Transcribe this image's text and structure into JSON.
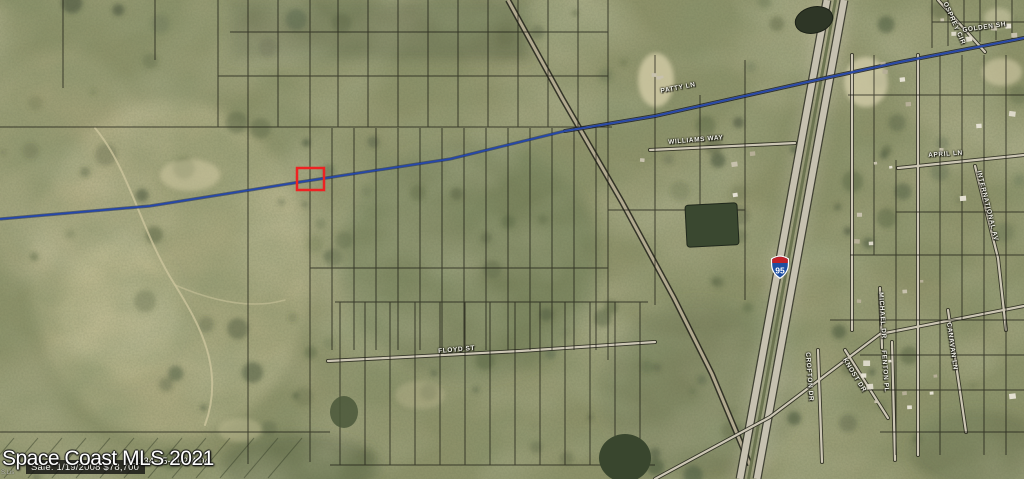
{
  "overlay": {
    "title": "Space Coast MLS 2021",
    "parcel_id": "21-34-15-AI-2-4.04",
    "sale_info": "Sale: 1/19/2008 $78,700",
    "corner_note": "S.Lis"
  },
  "map": {
    "type": "aerial-parcel-map",
    "highlighted_parcel_color": "#ee2222",
    "route_line_color": "#2547ab",
    "interstate_shield": {
      "number": "95"
    },
    "street_labels": [
      {
        "text": "PATTY LN",
        "x": 660,
        "y": 88,
        "rot": -11
      },
      {
        "text": "WILLIAMS WAY",
        "x": 668,
        "y": 139,
        "rot": -5
      },
      {
        "text": "FLOYD ST",
        "x": 438,
        "y": 348,
        "rot": -5
      },
      {
        "text": "GOLDEN SH",
        "x": 962,
        "y": 27,
        "rot": -8
      },
      {
        "text": "APRIL LN",
        "x": 928,
        "y": 152,
        "rot": -4
      },
      {
        "text": "INTERNATIONAL AV",
        "x": 982,
        "y": 170,
        "rot": 76
      },
      {
        "text": "OSPREY CIR",
        "x": 948,
        "y": 1,
        "rot": 66
      },
      {
        "text": "MICHAEL DR",
        "x": 884,
        "y": 292,
        "rot": 86
      },
      {
        "text": "KNOST DR",
        "x": 847,
        "y": 357,
        "rot": 58
      },
      {
        "text": "FENTON PL",
        "x": 887,
        "y": 350,
        "rot": 86
      },
      {
        "text": "CANAVAN LN",
        "x": 952,
        "y": 322,
        "rot": 82
      },
      {
        "text": "CROFTON DR",
        "x": 811,
        "y": 352,
        "rot": 86
      }
    ]
  }
}
